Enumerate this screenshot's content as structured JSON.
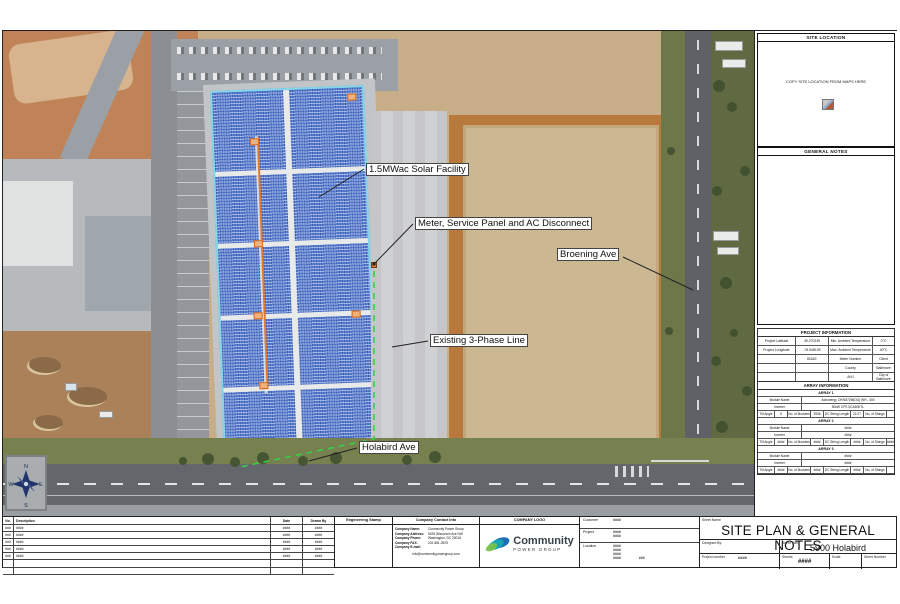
{
  "map": {
    "annotations": [
      {
        "label": "1.5MWac Solar Facility"
      },
      {
        "label": "Meter, Service Panel and AC Disconnect"
      },
      {
        "label": "Broening Ave"
      },
      {
        "label": "Existing 3-Phase Line"
      },
      {
        "label": "Holabird Ave"
      }
    ],
    "compass": {
      "n": "N",
      "e": "E",
      "s": "S",
      "w": "W"
    }
  },
  "colors": {
    "panel_blue": "#5f85d8",
    "array_outline": "#85d7e8",
    "conduit_orange": "#e07a30",
    "phase_line_green": "#35d148",
    "brand_dark": "#37424a",
    "brand_teal": "#18a8b0",
    "brand_blue": "#1d6fb8",
    "brand_green": "#7cc24a"
  },
  "right_panel": {
    "site_location_title": "SITE LOCATION",
    "site_location_note": "COPY SITE LOCATION FROM MAPS HERE",
    "general_notes_title": "GENERAL NOTES",
    "project_information": {
      "title": "PROJECT INFORMATION",
      "rows": [
        [
          "Project Latitude",
          "39.270239",
          "Min. Ambient Temperature",
          "0°C"
        ],
        [
          "Project Longitude",
          "-76.548109",
          "Max. Ambient Temperature",
          "40°C"
        ],
        [
          "",
          "BG&E",
          "Meter Number",
          "Client"
        ],
        [
          "",
          "",
          "County",
          "Baltimore"
        ],
        [
          "",
          "",
          "AHJ",
          "City of Baltimore"
        ]
      ]
    },
    "array_information": {
      "title": "ARRAY INFORMATION",
      "labels": {
        "module": "Module Name",
        "inverter": "Inverter",
        "tilt": "Tilt Angle",
        "modules": "No. of Modules",
        "dc": "DC String Length",
        "strings": "No. of Strings"
      },
      "arrays": [
        {
          "name": "ARRAY 1",
          "module": "Astronergy CHSM72M(DG) WH - 400",
          "inverter": "50kW CPS SCA50KTL",
          "tilt": "5",
          "modules": "3936",
          "dc": "22.27",
          "strings": ""
        },
        {
          "name": "ARRAY 2",
          "module": "####",
          "inverter": "####",
          "tilt": "####",
          "modules": "####",
          "dc": "####",
          "strings": "####"
        },
        {
          "name": "ARRAY 3",
          "module": "####",
          "inverter": "####",
          "tilt": "####",
          "modules": "####",
          "dc": "####",
          "strings": ""
        }
      ]
    }
  },
  "title_block": {
    "revision_table": {
      "headers": [
        "No.",
        "Description",
        "Date",
        "Drawn By"
      ],
      "rows": [
        [
          "###",
          "####",
          "####",
          "####"
        ],
        [
          "###",
          "####",
          "####",
          "####"
        ],
        [
          "###",
          "####",
          "####",
          "####"
        ],
        [
          "###",
          "####",
          "####",
          "####"
        ],
        [
          "###",
          "####",
          "####",
          "####"
        ],
        [
          "",
          "",
          "",
          ""
        ],
        [
          "",
          "",
          "",
          ""
        ]
      ]
    },
    "engineering_stamp_title": "Engineering Stamp",
    "contact": {
      "title": "Company Contact Info",
      "name_label": "Company Name:",
      "name": "Community Power Group",
      "address_label": "Company Address:",
      "address_lines": [
        "5028 Wisconsin Ave NW",
        "Washington, DC 20016",
        "202-681-0925"
      ],
      "phone_label": "Company Phone:",
      "fax_label": "Company FAX:",
      "email_label": "Company E-mail:",
      "email": "info@communitypowergroup.com"
    },
    "logo": {
      "title": "COMPANY LOGO",
      "brand_name": "Community",
      "brand_sub": "POWER GROUP"
    },
    "customer_block": {
      "customer_label": "Customer",
      "customer": "####",
      "project_label": "Project",
      "project_lines": [
        "####",
        "####"
      ],
      "location_label": "Location",
      "location_lines": [
        "####",
        "####",
        "####",
        "####"
      ],
      "location_extra": "###"
    },
    "sheet": {
      "name_label": "Sheet Name",
      "name": "SITE PLAN & GENERAL NOTES",
      "designed_by_label": "Designed By:",
      "project_number_label": "Project number",
      "project_number": "####",
      "sheet_title_label": "Sheet Title",
      "sheet_title": "5900 Holabird",
      "sheets_label": "Sheets",
      "sheets": "####",
      "scale_label": "Scale",
      "sheet_number_label": "Sheet Number"
    }
  }
}
